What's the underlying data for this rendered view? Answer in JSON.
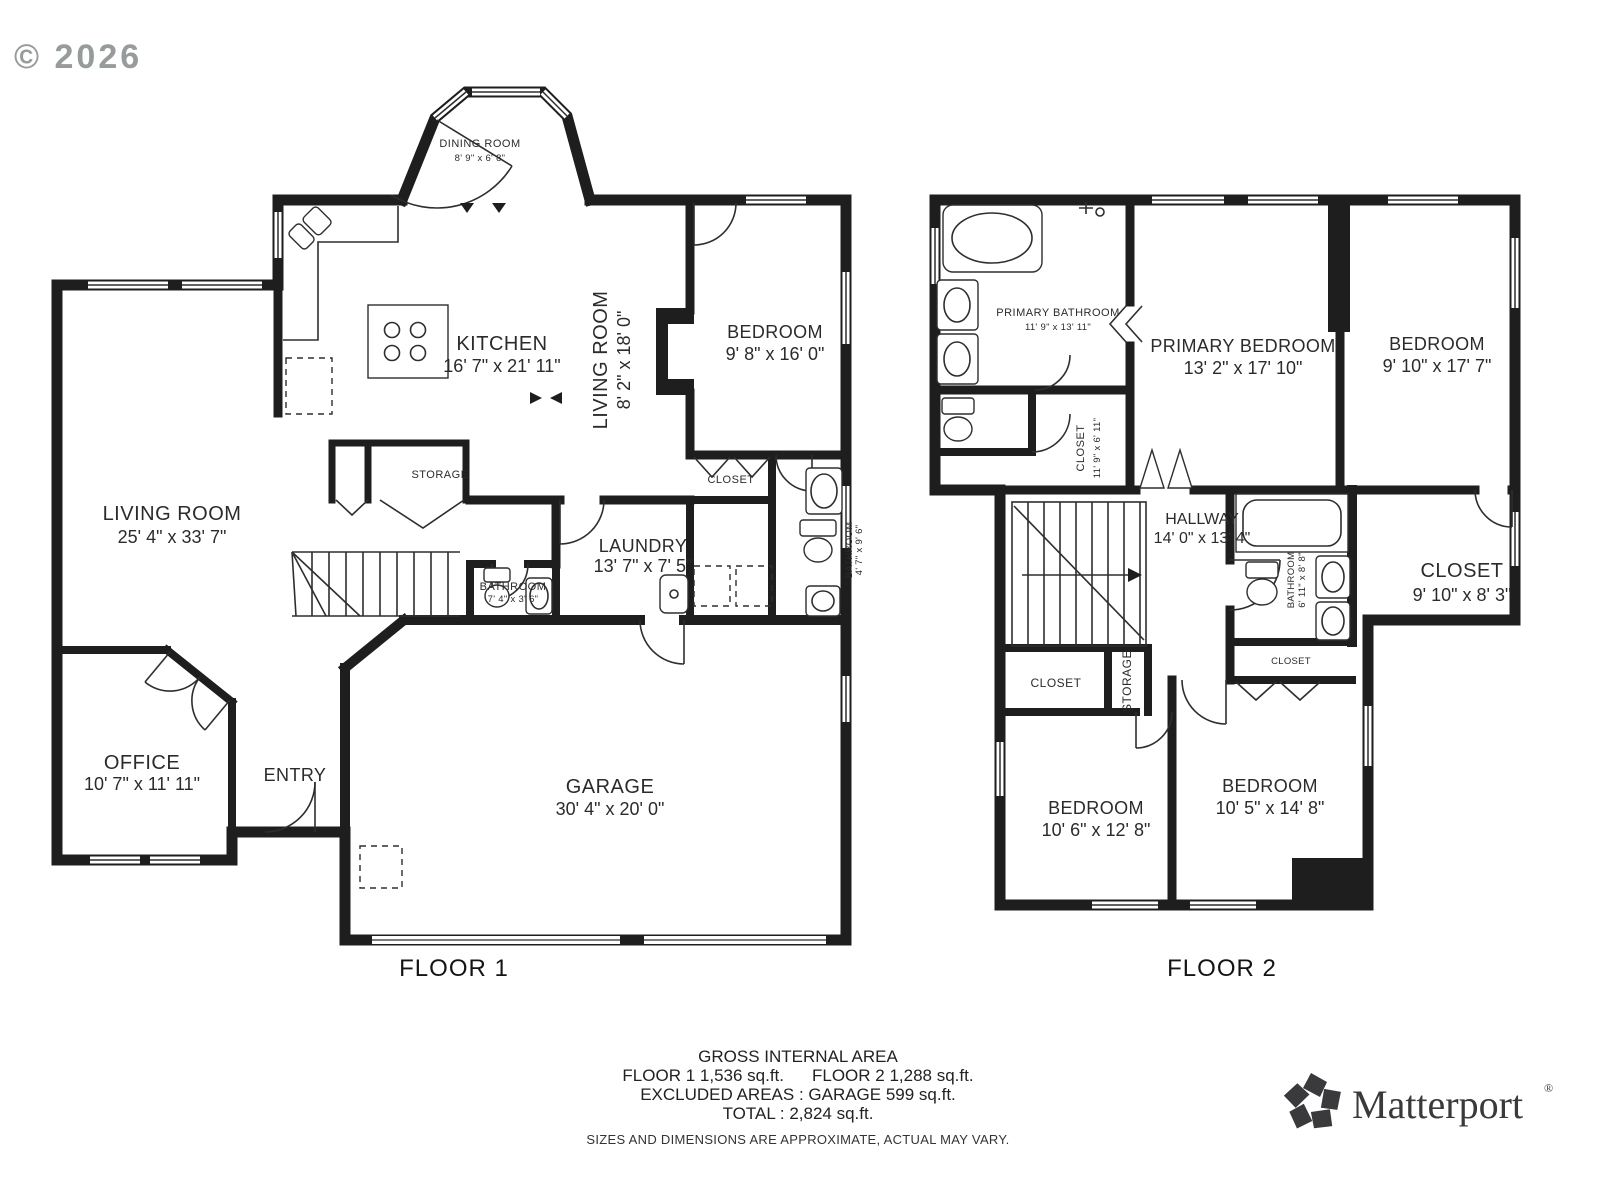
{
  "copyright": "© 2026",
  "floor1": {
    "label": "FLOOR 1",
    "rooms": {
      "dining": {
        "name": "DINING ROOM",
        "dims": "8' 9\" x 6' 8\""
      },
      "kitchen": {
        "name": "KITCHEN",
        "dims": "16' 7\" x 21' 11\""
      },
      "living_small": {
        "name": "LIVING ROOM",
        "dims": "8' 2\" x 18' 0\""
      },
      "bedroom": {
        "name": "BEDROOM",
        "dims": "9' 8\" x 16' 0\""
      },
      "living": {
        "name": "LIVING ROOM",
        "dims": "25' 4\" x 33' 7\""
      },
      "storage": {
        "name": "STORAGE"
      },
      "closet": {
        "name": "CLOSET"
      },
      "laundry": {
        "name": "LAUNDRY",
        "dims": "13' 7\" x 7' 5\""
      },
      "bathroom_small": {
        "name": "BATHROOM",
        "dims": "7' 4\" x 3' 6\""
      },
      "bathroom_right": {
        "name": "BATHROOM",
        "dims": "4' 7\" x 9' 6\""
      },
      "office": {
        "name": "OFFICE",
        "dims": "10' 7\" x 11' 11\""
      },
      "entry": {
        "name": "ENTRY"
      },
      "garage": {
        "name": "GARAGE",
        "dims": "30' 4\" x 20' 0\""
      }
    }
  },
  "floor2": {
    "label": "FLOOR 2",
    "rooms": {
      "primary_bathroom": {
        "name": "PRIMARY BATHROOM",
        "dims": "11' 9\" x 13' 11\""
      },
      "primary_bedroom": {
        "name": "PRIMARY BEDROOM",
        "dims": "13' 2\" x 17' 10\""
      },
      "bedroom_right": {
        "name": "BEDROOM",
        "dims": "9' 10\" x 17' 7\""
      },
      "closet_primary": {
        "name": "CLOSET",
        "dims": "11' 9\" x 6' 11\""
      },
      "hallway": {
        "name": "HALLWAY",
        "dims": "14' 0\" x 13' 4\""
      },
      "bathroom": {
        "name": "BATHROOM",
        "dims": "6' 11\" x 8' 8\""
      },
      "closet_right": {
        "name": "CLOSET",
        "dims": "9' 10\" x 8' 3\""
      },
      "closet_hall": {
        "name": "CLOSET"
      },
      "storage": {
        "name": "STORAGE"
      },
      "closet_small": {
        "name": "CLOSET"
      },
      "bedroom_left": {
        "name": "BEDROOM",
        "dims": "10' 6\" x 12' 8\""
      },
      "bedroom_bottom": {
        "name": "BEDROOM",
        "dims": "10' 5\" x 14' 8\""
      }
    }
  },
  "footer": {
    "title": "GROSS INTERNAL AREA",
    "floor1_area": "FLOOR 1 1,536 sq.ft.",
    "floor2_area": "FLOOR 2 1,288 sq.ft.",
    "excluded": "EXCLUDED AREAS :  GARAGE 599 sq.ft.",
    "total": "TOTAL :  2,824 sq.ft.",
    "disclaimer": "SIZES AND DIMENSIONS ARE APPROXIMATE, ACTUAL MAY VARY."
  },
  "brand": {
    "wordmark": "Matterport",
    "registered": "®"
  }
}
